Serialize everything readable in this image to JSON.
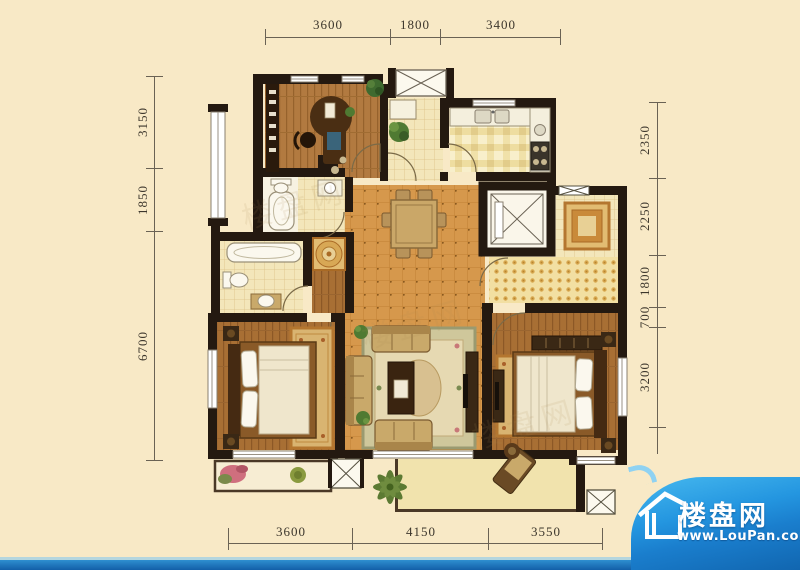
{
  "dimensions": {
    "top": [
      "3600",
      "1800",
      "3400"
    ],
    "bottom": [
      "3600",
      "4150",
      "3550"
    ],
    "left": [
      "3150",
      "1850",
      "6700"
    ],
    "right": [
      "2350",
      "2250",
      "1800",
      "700",
      "3200"
    ]
  },
  "watermark": "楼盘网",
  "logo": {
    "site_name": "楼盘网",
    "site_url": "www.LouPan.com"
  },
  "colors": {
    "background": "#f8e9c6",
    "wall": "#241910",
    "tile_orange": "#d6984c",
    "wood": "#ab7038",
    "brand_blue": "#1b7fd0"
  }
}
